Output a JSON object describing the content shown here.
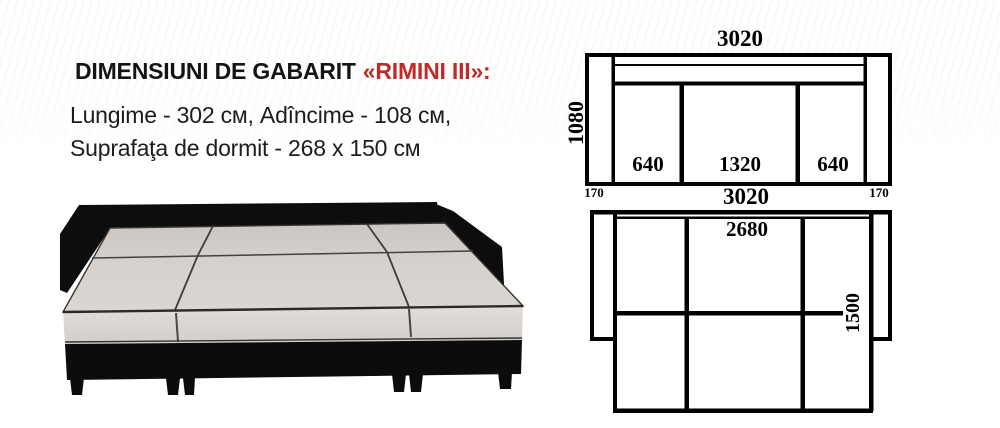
{
  "header": {
    "title_prefix": "DIMENSIUNI DE GABARIT",
    "title_model": "«RIMINI III»:",
    "specs_line1": "Lungime - 302 см, Adîncime - 108 см,",
    "specs_line2": "Suprafaţa de dormit - 268 x 150 см"
  },
  "front_view": {
    "total_width": "3020",
    "height": "1080",
    "seat_left": "640",
    "seat_center": "1320",
    "seat_right": "640"
  },
  "between_row": {
    "arm_left": "170",
    "total_width": "3020",
    "arm_right": "170"
  },
  "unfolded_view": {
    "sleeping_width": "2680",
    "sleeping_depth": "1500"
  },
  "colors": {
    "accent_red": "#c02b28",
    "diagram_line": "#000000",
    "mattress_gray": "#d6d1cc",
    "frame_black": "#0d0d0d"
  }
}
